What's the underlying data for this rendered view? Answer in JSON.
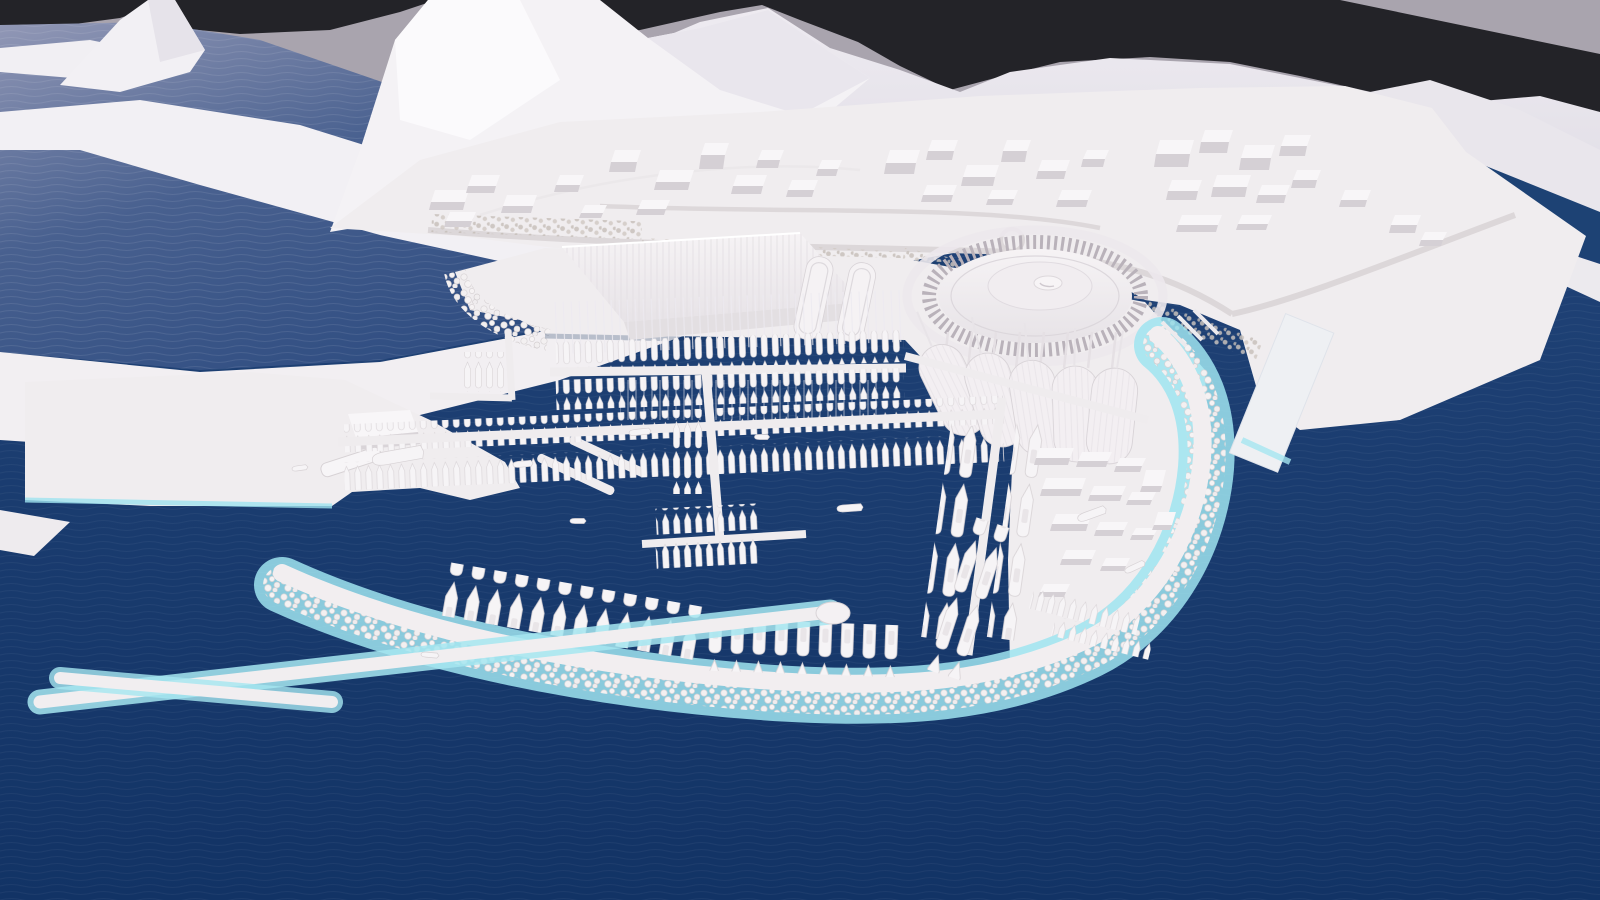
{
  "meta": {
    "title": "Marina waterfront masterplan - aerial massing render",
    "render_style": "white architectural massing model over dark blue sea",
    "view": "high-angle aerial perspective"
  },
  "palette": {
    "sky_upper": "#a9a4ae",
    "sky_band": "#232328",
    "mountain_bright": "#f4f2f5",
    "mountain_mid": "#e8e5ec",
    "mountain_distant": "#dddae3",
    "inlet_light": "#9298b6",
    "inlet_dark": "#2b4a7f",
    "sea_top": "#24477c",
    "sea_deep": "#123365",
    "land_white": "#f0edef",
    "structure_bright": "#f6f3f5",
    "structure_shade": "#e7e3e7",
    "building_side": "#d5d0d5",
    "shore_cyan": "#9fe4f0",
    "rock_gray": "#d8d3d5",
    "tree_gray": "#c8c1bb",
    "pier_white": "#efecee",
    "boat_white": "#f6f4f6",
    "shadow_navy": "#0f2f5c"
  },
  "scene": {
    "sky": {
      "upper": "pale lavender-gray sky",
      "band": "dark backdrop band behind mountain skyline"
    },
    "mountains": [
      {
        "label": "left white peak"
      },
      {
        "label": "central bright massif"
      },
      {
        "label": "distant eastern range"
      },
      {
        "label": "right coastal slope"
      }
    ],
    "water_areas": [
      {
        "label": "upper-left fjord inlet",
        "tone": "slate blue with ripple sheen"
      },
      {
        "label": "harbor basin",
        "tone": "deep navy"
      },
      {
        "label": "open sea",
        "tone": "deep navy"
      },
      {
        "label": "waterfront canal",
        "tone": "deep navy"
      },
      {
        "label": "east entrance channel",
        "tone": "deep navy"
      }
    ],
    "mainland": {
      "label": "city plateau",
      "buildings_estimate": 38,
      "features": [
        "waterfront boulevard",
        "street tree rows",
        "roundabout",
        "coastal road causeway"
      ]
    },
    "marina": {
      "facilities": [
        {
          "label": "exhibition hall",
          "note": "long ribbed flat roof"
        },
        {
          "label": "twin vaulted pavilions",
          "count": 2
        },
        {
          "label": "circular arena",
          "note": "radial fin ring with raised center disk"
        },
        {
          "label": "event canopies",
          "count": 5,
          "note": "tensile shells with masts"
        },
        {
          "label": "boatyard village",
          "buildings_estimate": 14
        }
      ],
      "piers": [
        "north sailboat pier",
        "second berthing pier",
        "central T-pier",
        "west L-pier",
        "east double-berth pier",
        "south yacht quay",
        "left harbor quay with finger piers",
        "right commercial pier",
        "west inner arm jetty"
      ],
      "berthed_small_boats_estimate": 280,
      "berthed_yachts_estimate": 70,
      "boats_underway_estimate": 10,
      "dry_storage_rows": 2
    },
    "breakwater": {
      "label": "rock-armored breakwater",
      "note": "white rip-rap edge with pale cyan waterline fringe, hooks from west around to northeast"
    },
    "vessels": {
      "docked_ship": "small ferry at left harbor quay"
    }
  }
}
